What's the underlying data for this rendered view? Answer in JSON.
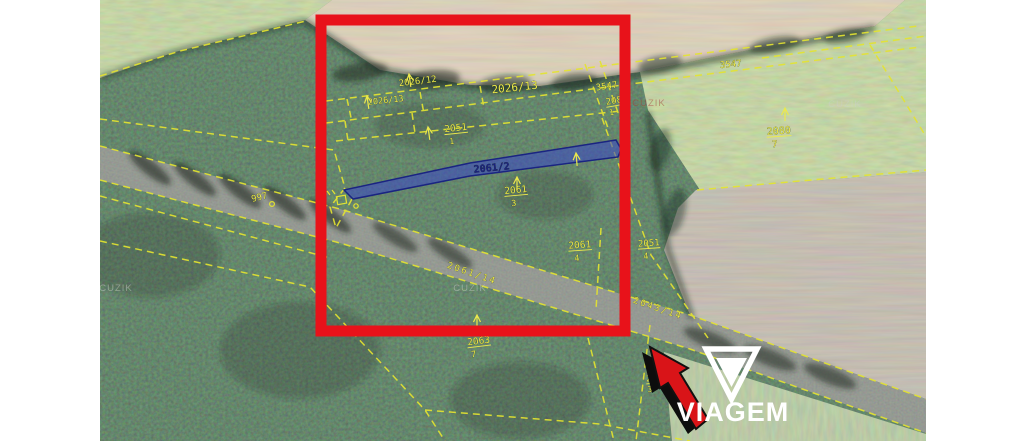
{
  "brand": {
    "name": "VIAGEM"
  },
  "map": {
    "highlight_box_color": "#e8121a",
    "parcel_line_color": "#e3e331",
    "label_color": "#ece94c",
    "selected_parcel": {
      "label": "2061/2",
      "fill": "#3946c8",
      "border": "#1a2482"
    },
    "parcel_labels": [
      {
        "text": "2026/12",
        "x": 418,
        "y": 84,
        "rot": -7,
        "size": 9
      },
      {
        "text": "2026/13",
        "x": 515,
        "y": 91,
        "rot": -6,
        "size": 11
      },
      {
        "text": "2026/13",
        "x": 386,
        "y": 103,
        "rot": -6,
        "size": 8.5
      },
      {
        "text": "3547",
        "x": 607,
        "y": 89,
        "rot": -8,
        "size": 9
      },
      {
        "text": "3547",
        "x": 731,
        "y": 67,
        "rot": -5,
        "size": 9
      },
      {
        "text": "2080",
        "x": 617,
        "y": 103,
        "rot": -10,
        "size": 9,
        "underline": true
      },
      {
        "text": "1",
        "x": 612,
        "y": 115,
        "rot": -10,
        "size": 8
      },
      {
        "text": "2080",
        "x": 779,
        "y": 134,
        "rot": -4,
        "size": 10,
        "underline": true
      },
      {
        "text": "7",
        "x": 775,
        "y": 147,
        "rot": -4,
        "size": 9
      },
      {
        "text": "2051",
        "x": 456,
        "y": 131,
        "rot": -6,
        "size": 9.5,
        "underline": true
      },
      {
        "text": "1",
        "x": 452,
        "y": 144,
        "rot": -6,
        "size": 8
      },
      {
        "text": "2061/2",
        "x": 492,
        "y": 171,
        "rot": -5.5,
        "size": 10,
        "color": "#1b2380",
        "bold": true
      },
      {
        "text": "2061",
        "x": 516,
        "y": 193,
        "rot": -5,
        "size": 9.5,
        "underline": true
      },
      {
        "text": "3",
        "x": 514,
        "y": 206,
        "rot": -5,
        "size": 8.5
      },
      {
        "text": "2061",
        "x": 580,
        "y": 248,
        "rot": -4,
        "size": 9.5,
        "underline": true
      },
      {
        "text": "4",
        "x": 577,
        "y": 261,
        "rot": -4,
        "size": 8.5
      },
      {
        "text": "2051",
        "x": 649,
        "y": 246,
        "rot": -4,
        "size": 9,
        "underline": true
      },
      {
        "text": "4",
        "x": 646,
        "y": 259,
        "rot": -4,
        "size": 8.5
      },
      {
        "text": "2061/14",
        "x": 471,
        "y": 276,
        "rot": 19,
        "size": 9,
        "spacing": 2
      },
      {
        "text": "2043/14",
        "x": 657,
        "y": 311,
        "rot": 19,
        "size": 9,
        "spacing": 2
      },
      {
        "text": "2063",
        "x": 479,
        "y": 344,
        "rot": -7,
        "size": 9.5,
        "underline": true
      },
      {
        "text": "7",
        "x": 474,
        "y": 357,
        "rot": -7,
        "size": 8.5
      },
      {
        "text": "26",
        "x": 651,
        "y": 381,
        "rot": -6,
        "size": 8,
        "underline": true
      },
      {
        "text": "3",
        "x": 650,
        "y": 392,
        "rot": -6,
        "size": 8
      },
      {
        "text": "997",
        "x": 260,
        "y": 200,
        "rot": -14,
        "size": 9
      }
    ],
    "north_arrows": [
      {
        "x": 409,
        "y": 74,
        "rot": -8
      },
      {
        "x": 367,
        "y": 96,
        "rot": -8
      },
      {
        "x": 428,
        "y": 127,
        "rot": -8
      },
      {
        "x": 517,
        "y": 177,
        "rot": 0
      },
      {
        "x": 576,
        "y": 153,
        "rot": -5
      },
      {
        "x": 785,
        "y": 108,
        "rot": 0
      },
      {
        "x": 477,
        "y": 315,
        "rot": 0
      }
    ],
    "watermarks": [
      {
        "text": "CUZIK",
        "x": 116,
        "y": 291,
        "color": "#c9cfc7"
      },
      {
        "text": "CUZIK",
        "x": 470,
        "y": 291,
        "color": "#c9cfc7"
      },
      {
        "text": "CUZIK",
        "x": 845,
        "y": 107,
        "color": "#c9cfc7"
      },
      {
        "text": "CUZIK",
        "x": 649,
        "y": 106,
        "color": "#a04038"
      }
    ]
  }
}
